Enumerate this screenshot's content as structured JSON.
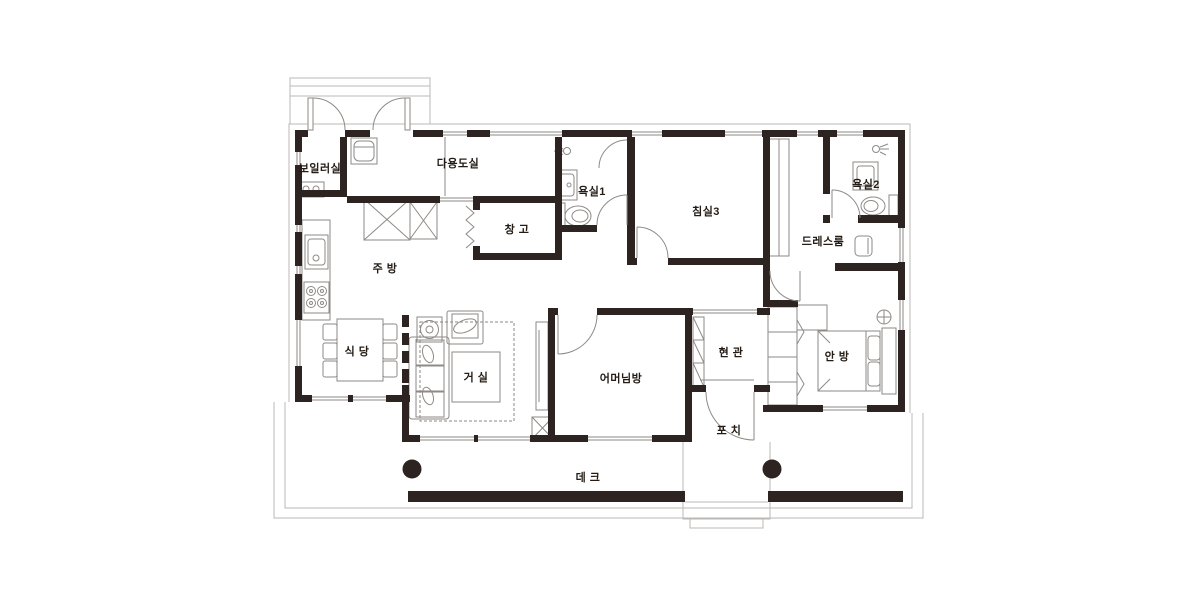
{
  "colors": {
    "wall": "#2d2321",
    "line": "#8e8a87",
    "light": "#bcb8b5",
    "text": "#241c14",
    "bg": "#ffffff"
  },
  "rooms": [
    {
      "name": "boiler-room",
      "label": "보일러실"
    },
    {
      "name": "utility-room",
      "label": "다용도실"
    },
    {
      "name": "bathroom-1",
      "label": "욕실1"
    },
    {
      "name": "storage",
      "label": "창 고"
    },
    {
      "name": "bedroom-3",
      "label": "침실3"
    },
    {
      "name": "bathroom-2",
      "label": "욕실2"
    },
    {
      "name": "dress-room",
      "label": "드레스룸"
    },
    {
      "name": "kitchen",
      "label": "주 방"
    },
    {
      "name": "dining-room",
      "label": "식 당"
    },
    {
      "name": "living-room",
      "label": "거 실"
    },
    {
      "name": "mothers-room",
      "label": "어머님방"
    },
    {
      "name": "entrance",
      "label": "현 관"
    },
    {
      "name": "master-bedroom",
      "label": "안 방"
    },
    {
      "name": "porch",
      "label": "포 치"
    },
    {
      "name": "deck",
      "label": "데 크"
    }
  ]
}
